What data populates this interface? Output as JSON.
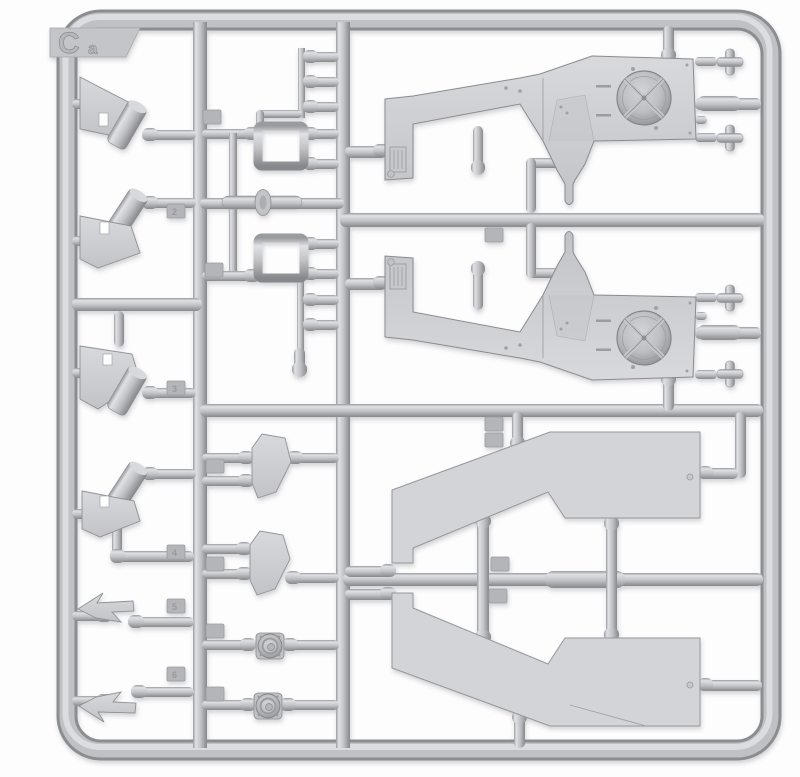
{
  "meta": {
    "title": "Light-gray styrene model kit sprue, frame C — photographed on white background"
  },
  "sprue": {
    "corner_label": {
      "letter": "C",
      "suffix": "a"
    },
    "colors": {
      "plastic_mid": "#c2c3c7",
      "plastic_highlight": "#e0e1e4",
      "plastic_shadow": "#8b8c90",
      "part_face": "#d3d4d7",
      "outline": "#8e8f93",
      "background": "#fdfdfe"
    }
  },
  "part_tags": [
    {
      "label": "2"
    },
    {
      "label": "3"
    },
    {
      "label": "4"
    },
    {
      "label": "5"
    },
    {
      "label": "6"
    },
    {
      "label": ""
    },
    {
      "label": ""
    },
    {
      "label": ""
    },
    {
      "label": ""
    },
    {
      "label": ""
    },
    {
      "label": ""
    },
    {
      "label": ""
    },
    {
      "label": ""
    },
    {
      "label": ""
    },
    {
      "label": ""
    },
    {
      "label": ""
    }
  ],
  "parts_inventory": [
    {
      "name": "fender-assembly-with-fan-recess",
      "quantity": 2
    },
    {
      "name": "large-hull-side-panel",
      "quantity": 2
    },
    {
      "name": "wedge-bracket-with-roller",
      "quantity": 4
    },
    {
      "name": "swept-wing-bracket",
      "quantity": 2
    },
    {
      "name": "shield-plate",
      "quantity": 2
    },
    {
      "name": "pulley-wheel",
      "quantity": 2
    },
    {
      "name": "rectangular-tube-loop",
      "quantity": 2
    },
    {
      "name": "cross-cap",
      "quantity": 4
    },
    {
      "name": "flanged-pin",
      "quantity": 1
    },
    {
      "name": "bullet-connector-pin",
      "quantity": 13
    }
  ]
}
